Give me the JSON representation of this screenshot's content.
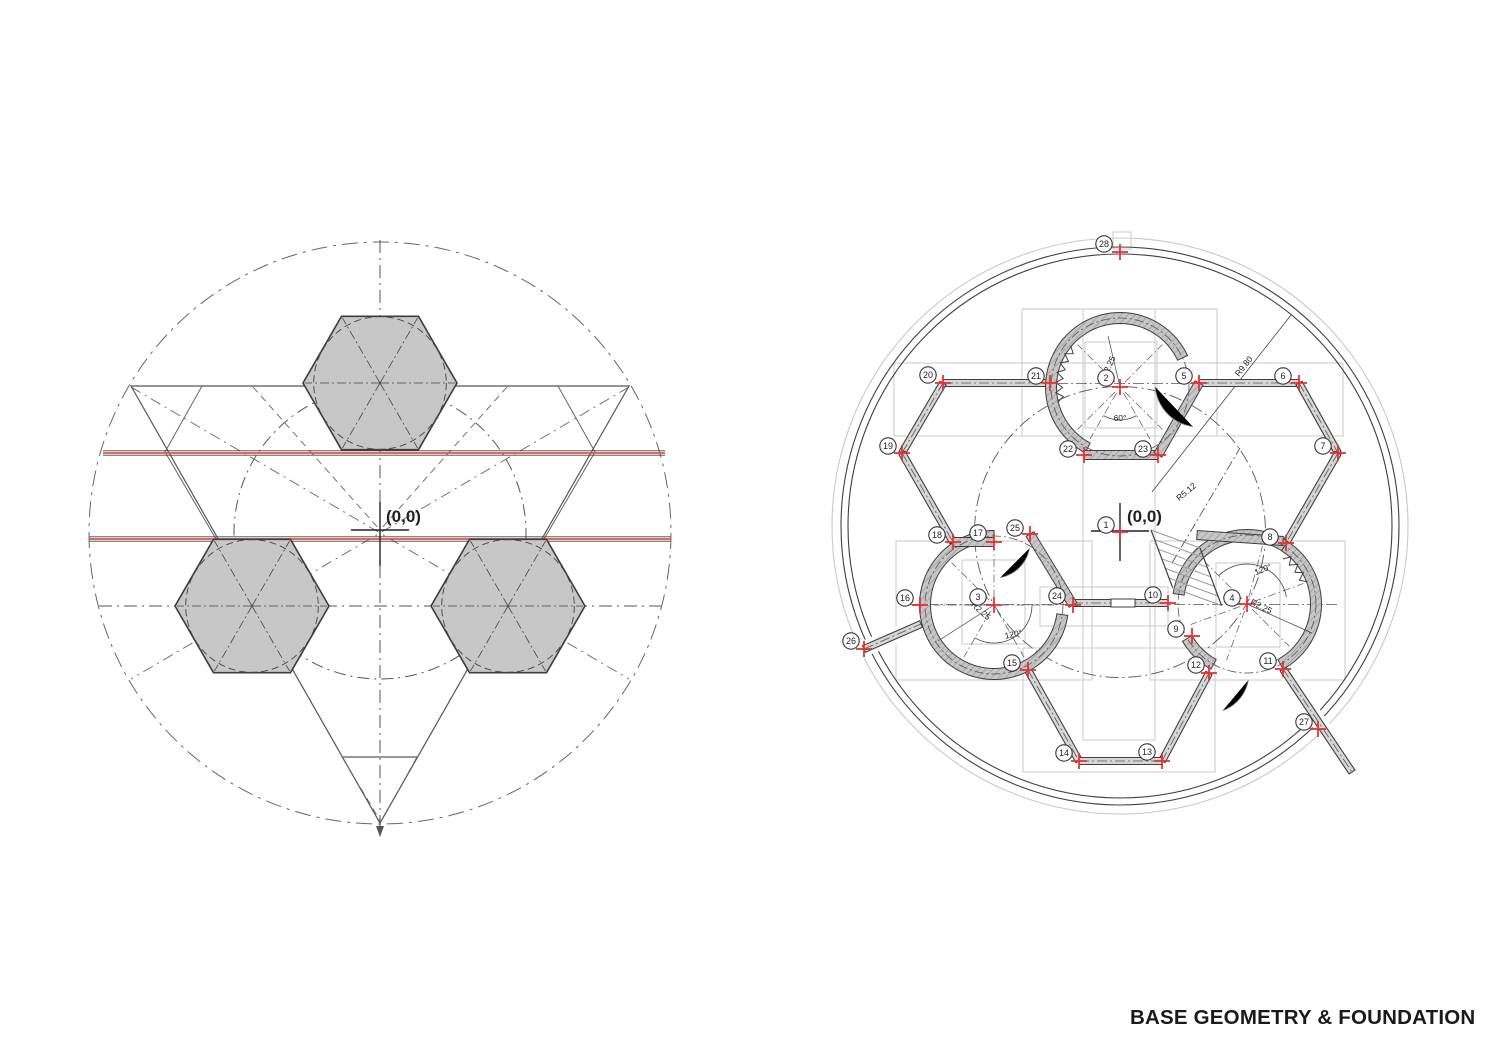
{
  "page": {
    "title": "BASE GEOMETRY & FOUNDATION"
  },
  "colors": {
    "red_accent": "#e8312e",
    "red_line": "#e05252",
    "line_dark": "#3f3f3f",
    "line_mid": "#666666",
    "light_gray": "#c9c9c9",
    "hex_fill": "#c7c7c7",
    "wall_fill": "#c6c6c6",
    "hatch": "#8f8f8f"
  },
  "left_diagram": {
    "origin_label": "(0,0)"
  },
  "right_diagram": {
    "origin_label": "(0,0)",
    "dimension_labels": [
      {
        "text": "R9.80",
        "x": 1246,
        "y": 368,
        "rot": -52
      },
      {
        "text": "R5.12",
        "x": 1188,
        "y": 494,
        "rot": -40
      },
      {
        "text": "R2.25",
        "x": 1111,
        "y": 368,
        "rot": -65
      },
      {
        "text": "R2.25",
        "x": 979,
        "y": 613,
        "rot": 42
      },
      {
        "text": "R2.25",
        "x": 1260,
        "y": 609,
        "rot": 26
      }
    ],
    "angle_labels": [
      {
        "text": "60°",
        "x": 1120,
        "y": 421,
        "rot": 0
      },
      {
        "text": "120°",
        "x": 1014,
        "y": 637,
        "rot": -12
      },
      {
        "text": "120°",
        "x": 1264,
        "y": 572,
        "rot": -22
      }
    ],
    "markers": [
      {
        "n": "1",
        "bx": 1106,
        "by": 525,
        "cx": 1120,
        "cy": 532
      },
      {
        "n": "2",
        "bx": 1106,
        "by": 378,
        "cx": 1120,
        "cy": 387
      },
      {
        "n": "3",
        "bx": 978,
        "by": 597,
        "cx": 994,
        "cy": 605
      },
      {
        "n": "4",
        "bx": 1232,
        "by": 598,
        "cx": 1247,
        "cy": 604
      },
      {
        "n": "5",
        "bx": 1184,
        "by": 376,
        "cx": 1199,
        "cy": 383
      },
      {
        "n": "6",
        "bx": 1283,
        "by": 376,
        "cx": 1299,
        "cy": 383
      },
      {
        "n": "7",
        "bx": 1323,
        "by": 446,
        "cx": 1338,
        "cy": 453
      },
      {
        "n": "8",
        "bx": 1270,
        "by": 537,
        "cx": 1286,
        "cy": 543
      },
      {
        "n": "9",
        "bx": 1176,
        "by": 629,
        "cx": 1192,
        "cy": 636
      },
      {
        "n": "10",
        "bx": 1153,
        "by": 595,
        "cx": 1168,
        "cy": 603
      },
      {
        "n": "11",
        "bx": 1268,
        "by": 661,
        "cx": 1283,
        "cy": 669
      },
      {
        "n": "12",
        "bx": 1196,
        "by": 665,
        "cx": 1209,
        "cy": 673
      },
      {
        "n": "13",
        "bx": 1147,
        "by": 752,
        "cx": 1162,
        "cy": 761
      },
      {
        "n": "14",
        "bx": 1064,
        "by": 753,
        "cx": 1079,
        "cy": 761
      },
      {
        "n": "15",
        "bx": 1012,
        "by": 663,
        "cx": 1028,
        "cy": 670
      },
      {
        "n": "16",
        "bx": 905,
        "by": 598,
        "cx": 920,
        "cy": 605
      },
      {
        "n": "17",
        "bx": 978,
        "by": 533,
        "cx": 994,
        "cy": 542
      },
      {
        "n": "18",
        "bx": 937,
        "by": 535,
        "cx": 953,
        "cy": 542
      },
      {
        "n": "19",
        "bx": 888,
        "by": 446,
        "cx": 902,
        "cy": 453
      },
      {
        "n": "20",
        "bx": 928,
        "by": 375,
        "cx": 943,
        "cy": 383
      },
      {
        "n": "21",
        "bx": 1036,
        "by": 376,
        "cx": 1050,
        "cy": 383
      },
      {
        "n": "22",
        "bx": 1068,
        "by": 449,
        "cx": 1084,
        "cy": 455
      },
      {
        "n": "23",
        "bx": 1143,
        "by": 449,
        "cx": 1158,
        "cy": 455
      },
      {
        "n": "24",
        "bx": 1057,
        "by": 596,
        "cx": 1073,
        "cy": 605
      },
      {
        "n": "25",
        "bx": 1015,
        "by": 528,
        "cx": 1030,
        "cy": 534
      },
      {
        "n": "26",
        "bx": 851,
        "by": 641,
        "cx": 864,
        "cy": 649
      },
      {
        "n": "27",
        "bx": 1304,
        "by": 722,
        "cx": 1318,
        "cy": 729
      },
      {
        "n": "28",
        "bx": 1104,
        "by": 244,
        "cx": 1120,
        "cy": 252
      }
    ]
  }
}
